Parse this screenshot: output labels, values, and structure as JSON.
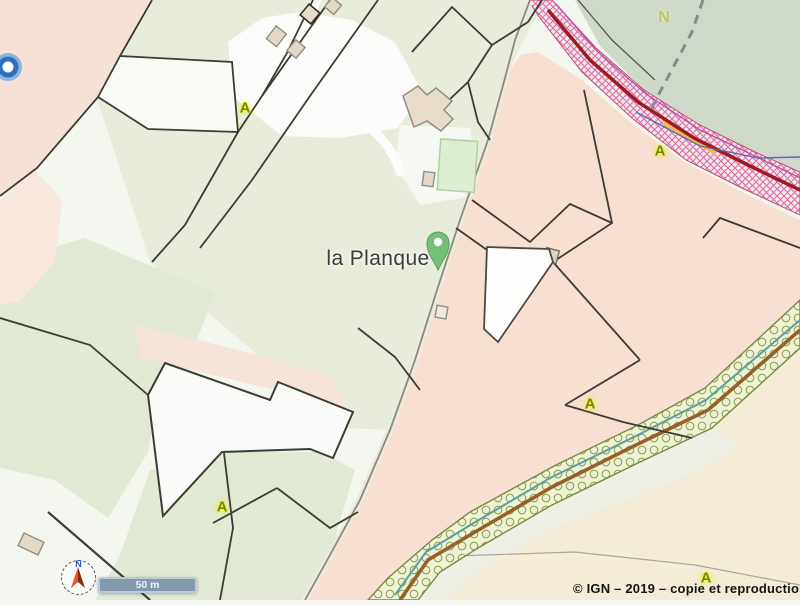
{
  "map": {
    "place_label": "la Planque",
    "boundary_label": "N",
    "zone_labels": [
      {
        "text": "A",
        "x": 245,
        "y": 108
      },
      {
        "text": "A",
        "x": 660,
        "y": 151
      },
      {
        "text": "A",
        "x": 590,
        "y": 404
      },
      {
        "text": "A",
        "x": 222,
        "y": 507
      },
      {
        "text": "A",
        "x": 706,
        "y": 578
      }
    ],
    "compass": {
      "label": "N"
    },
    "scale_bar": {
      "label": "50 m"
    },
    "copyright": "© IGN – 2019 – copie et reproduction in",
    "colors": {
      "parcel_pink": "#f6e1d3",
      "parcel_green": "#e7edda",
      "wooded_green": "#cfd9ca",
      "cream": "#f4ecd6",
      "crosshatch_pink": "#d86f9f",
      "road_red": "#9e1a24",
      "orchard_band_green": "#eef3d6",
      "stream_teal": "#5aa0a0",
      "path_brown": "#96602a",
      "pin_green": "#74c175",
      "poi_marker_blue": "#2e6fbe",
      "zone_label_glow": "#e8f000",
      "scalebar_fill": "#8499ac"
    }
  }
}
